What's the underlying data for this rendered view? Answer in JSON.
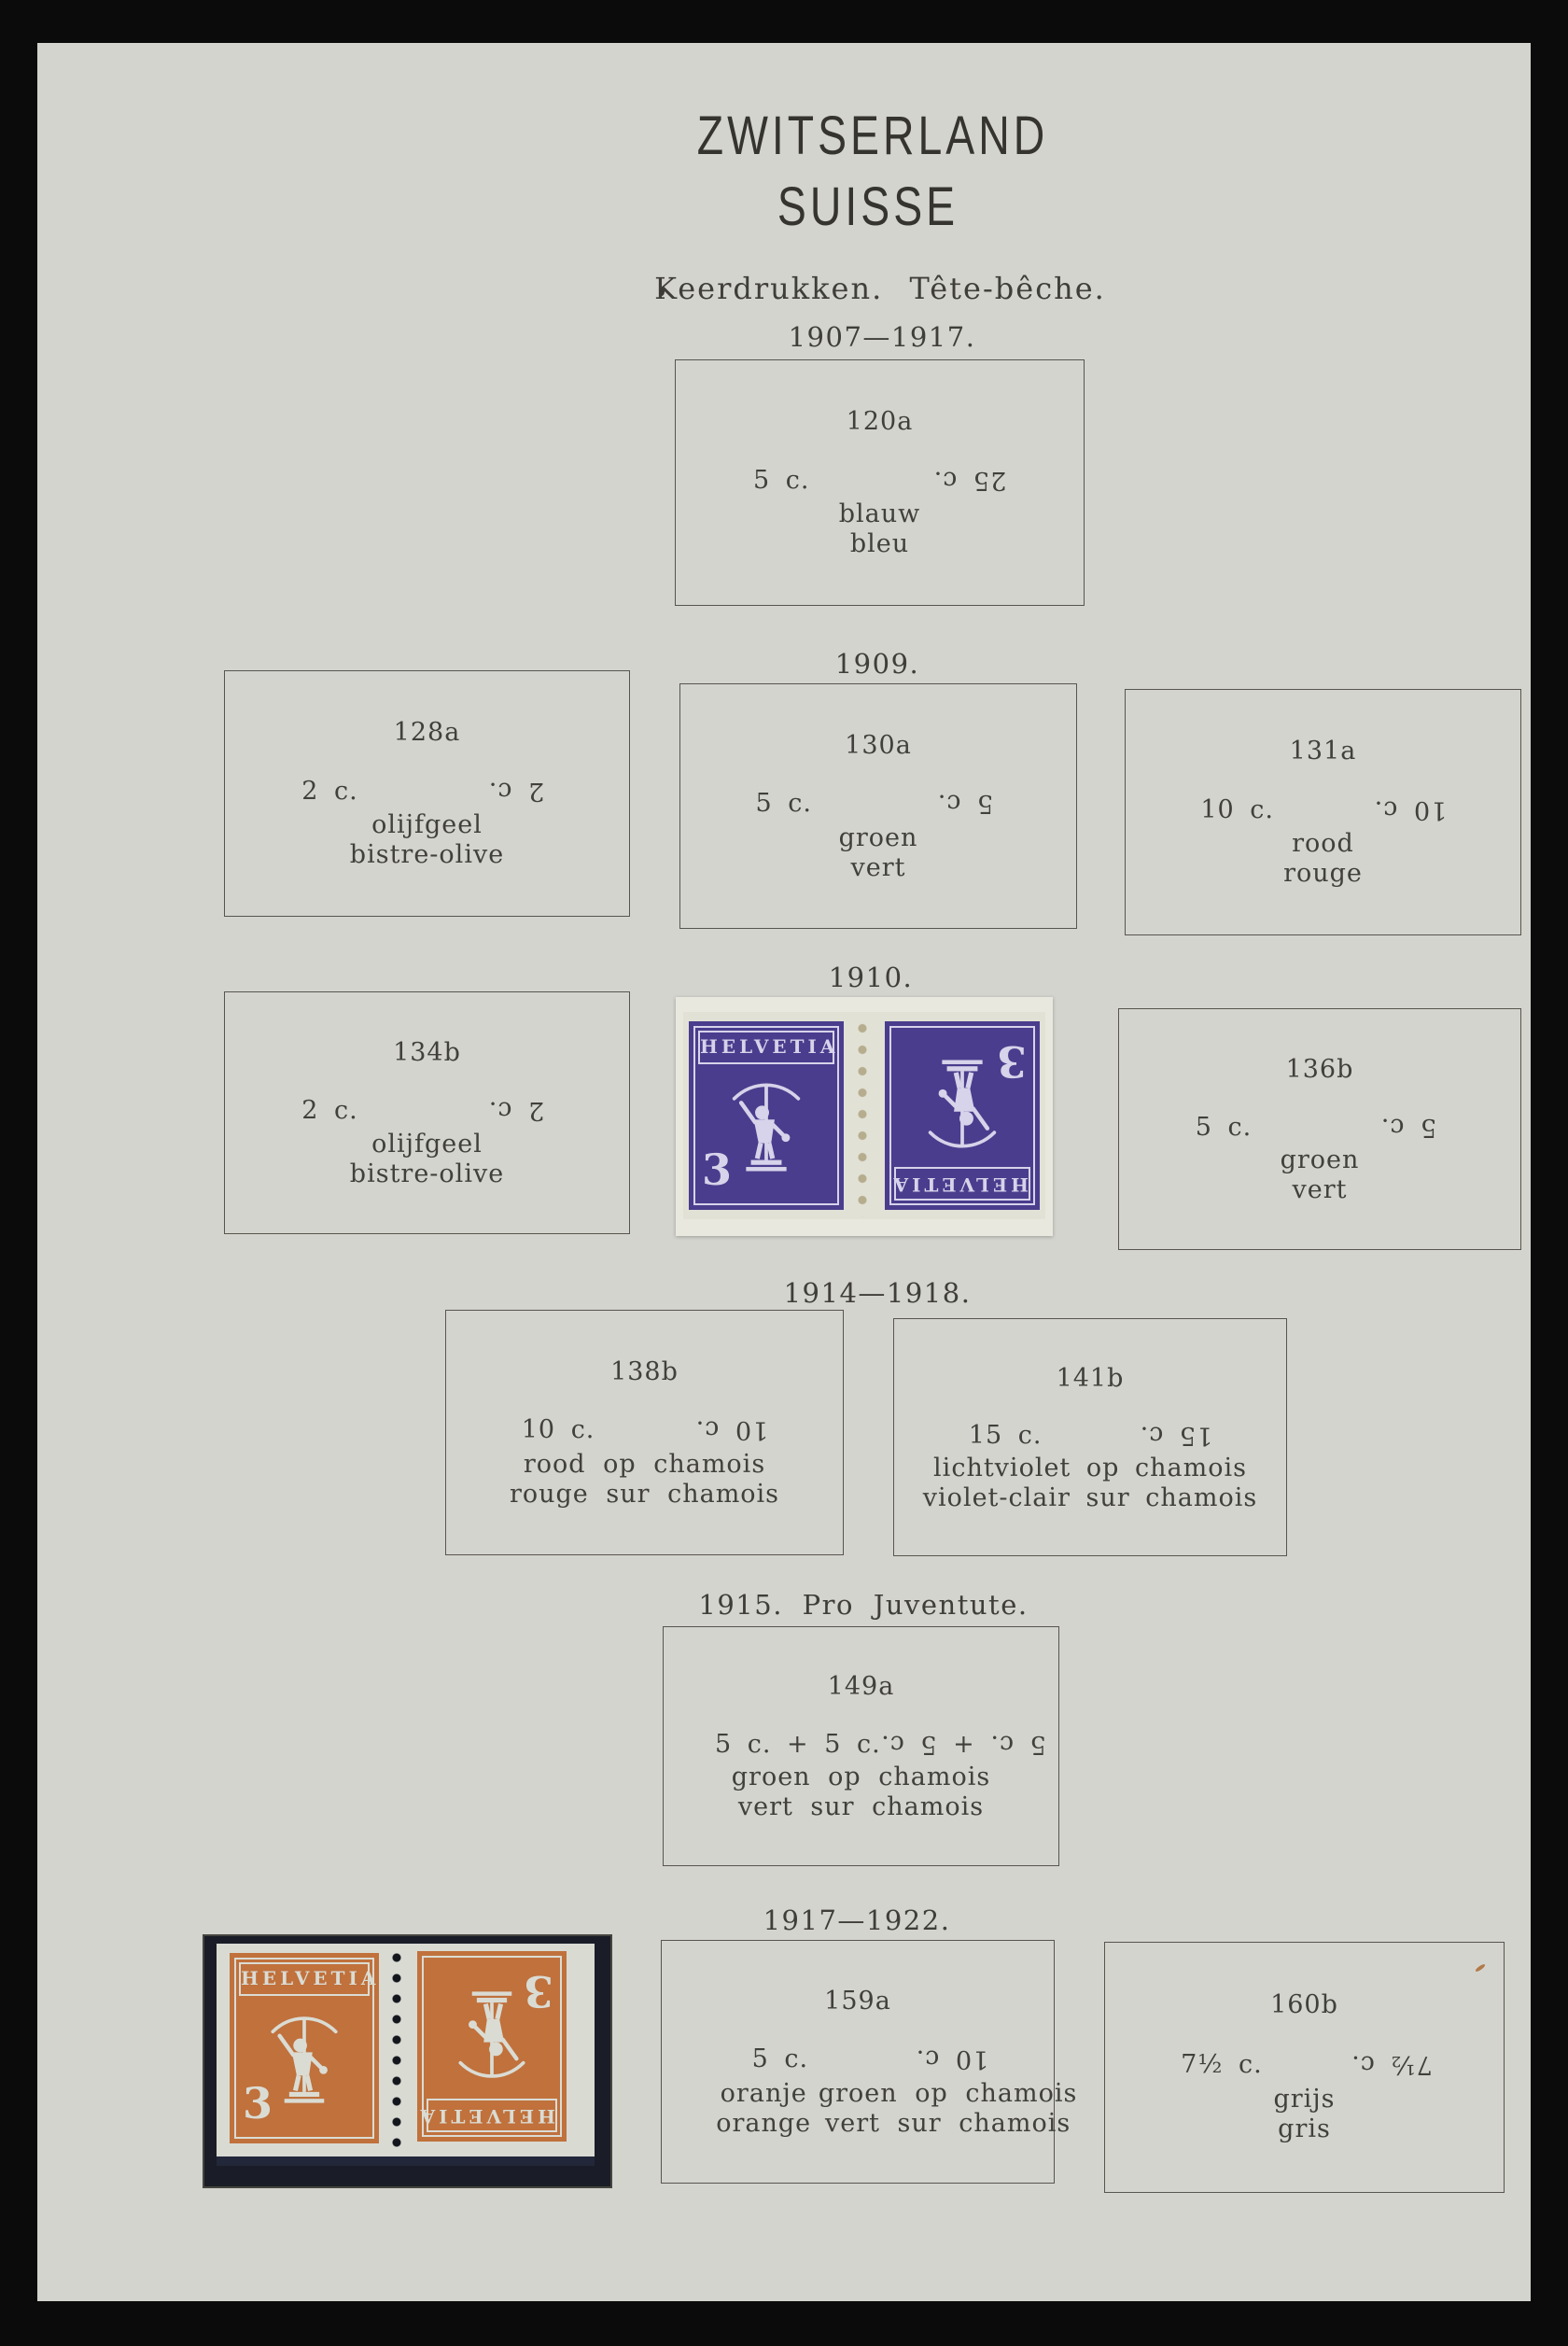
{
  "page": {
    "title_line1": "ZWITSERLAND",
    "title_line2": "SUISSE",
    "section_heading": "Keerdrukken.  Tête-bêche."
  },
  "sections": [
    {
      "label": "1907—1917."
    },
    {
      "label": "1909."
    },
    {
      "label": "1910."
    },
    {
      "label": "1914—1918."
    },
    {
      "label": "1915.  Pro  Juventute."
    },
    {
      "label": "1917—1922."
    }
  ],
  "boxes": [
    {
      "number": "120a",
      "left_value": "5 c.",
      "right_value_inverted": "25 c.",
      "colors": [
        "blauw",
        "bleu"
      ]
    },
    {
      "number": "128a",
      "left_value": "2 c.",
      "right_value_inverted": "2 c.",
      "colors": [
        "olijfgeel",
        "bistre-olive"
      ]
    },
    {
      "number": "130a",
      "left_value": "5 c.",
      "right_value_inverted": "5 c.",
      "colors": [
        "groen",
        "vert"
      ]
    },
    {
      "number": "131a",
      "left_value": "10 c.",
      "right_value_inverted": "10 c.",
      "colors": [
        "rood",
        "rouge"
      ]
    },
    {
      "number": "134b",
      "left_value": "2 c.",
      "right_value_inverted": "2 c.",
      "colors": [
        "olijfgeel",
        "bistre-olive"
      ]
    },
    {
      "number": "136b",
      "left_value": "5 c.",
      "right_value_inverted": "5 c.",
      "colors": [
        "groen",
        "vert"
      ]
    },
    {
      "number": "138b",
      "left_value": "10 c.",
      "right_value_inverted": "10 c.",
      "colors": [
        "rood op chamois",
        "rouge sur chamois"
      ]
    },
    {
      "number": "141b",
      "left_value": "15 c.",
      "right_value_inverted": "15 c.",
      "colors": [
        "lichtviolet op chamois",
        "violet-clair sur chamois"
      ]
    },
    {
      "number": "149a",
      "left_value": "5 c. + 5 c.",
      "right_value_inverted": "5 c. + 5 c.",
      "colors": [
        "groen op chamois",
        "vert sur chamois"
      ]
    },
    {
      "number": "159a",
      "left_value": "5 c.",
      "right_value_inverted": "10 c.",
      "left_colors": [
        "oranje",
        "orange"
      ],
      "right_colors": [
        "groen  op  chamois",
        "vert  sur  chamois"
      ]
    },
    {
      "number": "160b",
      "left_value": "7½ c.",
      "right_value_inverted": "7½ c.",
      "colors": [
        "grijs",
        "gris"
      ]
    }
  ],
  "stamp_pairs": {
    "violet_1910": {
      "country": "HELVETIA",
      "denomination": "3",
      "ink_color": "#4a3d8d",
      "paper_color": "#e9e8df"
    },
    "orange_1917": {
      "country": "HELVETIA",
      "denomination": "3",
      "ink_color": "#c0713c",
      "paper_color": "#d9dbd3",
      "mount_color": "#1a1d27"
    }
  }
}
